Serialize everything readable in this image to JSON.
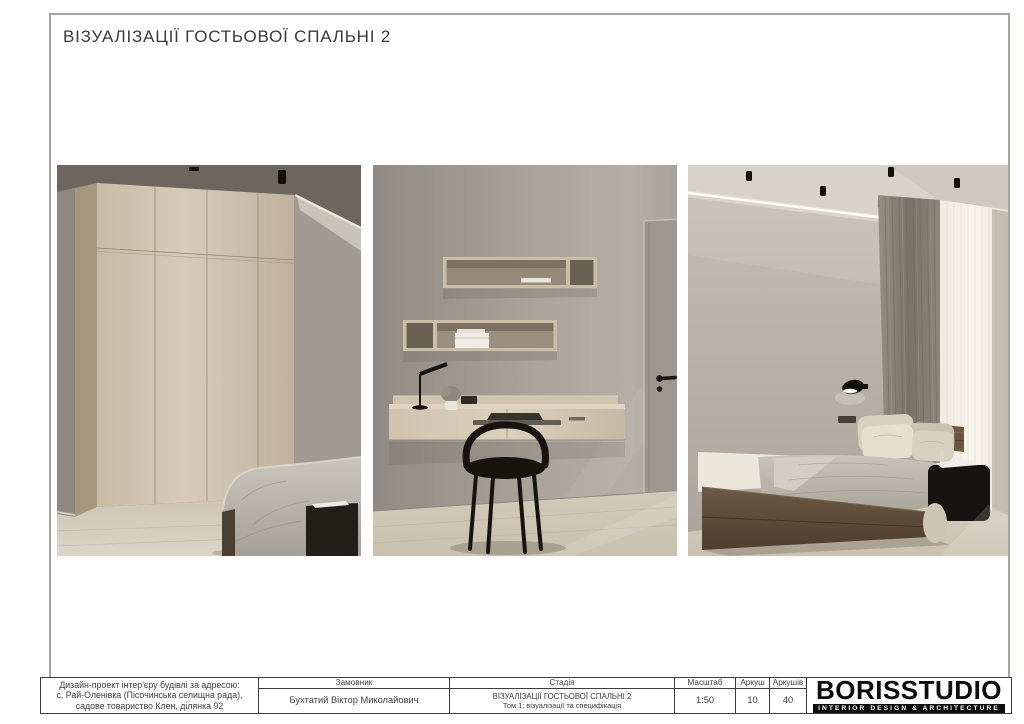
{
  "page": {
    "title": "ВІЗУАЛІЗАЦІЇ ГОСТЬОВОЇ СПАЛЬНІ 2"
  },
  "renders": [
    {
      "name": "wardrobe-and-bed-render",
      "label": "guest bedroom render: wardrobe and bed corner"
    },
    {
      "name": "desk-and-shelves-render",
      "label": "guest bedroom render: floating desk, shelves, chair and door"
    },
    {
      "name": "bed-and-window-render",
      "label": "guest bedroom render: bed, curtains and window"
    }
  ],
  "palette": {
    "wood": "#d0c3ae",
    "dark_wood": "#5c4a38",
    "wall": "#a8a098",
    "floor": "#d2c9b9",
    "black": "#17140f",
    "border_grey": "#a9a49e",
    "line_dark": "#3c3c3c"
  },
  "title_block": {
    "address": [
      "Дизайн-проект інтер'єру будівлі за адресою:",
      "с. Рай-Оленівка (Пісочинська селищна рада),",
      "садове товариство Клен, ділянка 92"
    ],
    "client_label": "Замовник",
    "client_name": "Бухтатий Віктор Миколайович",
    "stage_label": "Стадія",
    "stage_value_line1": "ВІЗУАЛІЗАЦІЇ ГОСТЬОВОЇ СПАЛЬНІ 2",
    "stage_value_line2": "Том 1: візуалізації та специфікація",
    "scale_label": "Масштаб",
    "scale_value": "1:50",
    "sheet_label": "Аркуш",
    "sheet_value": "10",
    "sheets_label": "Аркушів",
    "sheets_value": "40",
    "logo_name": "BORISSTUDIO",
    "logo_tagline": "INTERIOR DESIGN & ARCHITECTURE"
  }
}
